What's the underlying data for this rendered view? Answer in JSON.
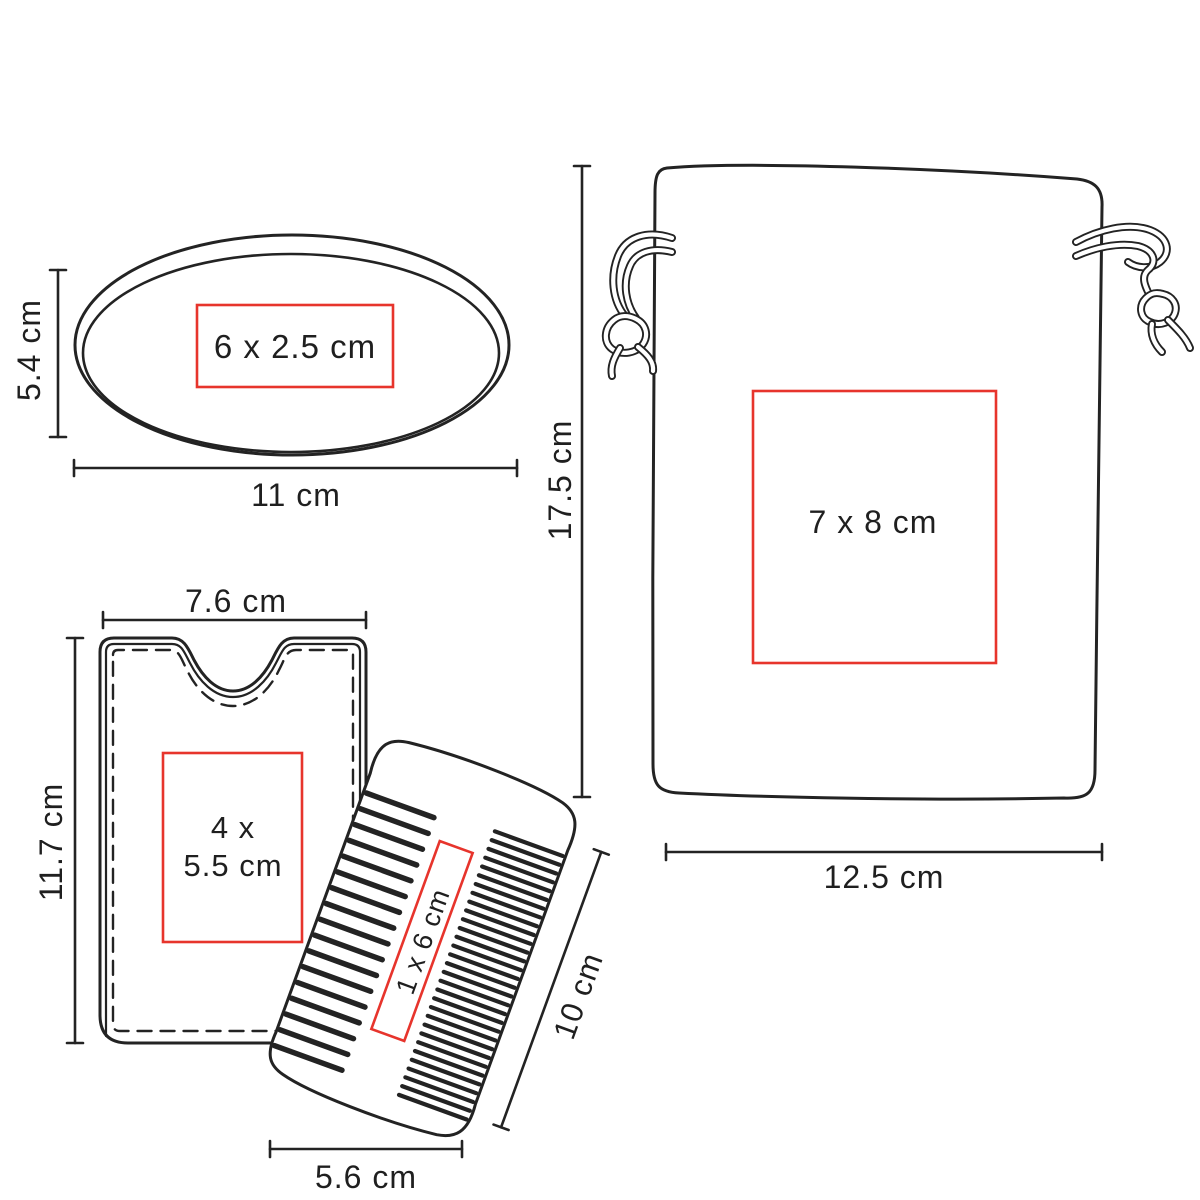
{
  "colors": {
    "background": "#ffffff",
    "line": "#232323",
    "accent": "#e7342c",
    "text": "#1f1f1f"
  },
  "mirror": {
    "print_area": "6 x 2.5 cm",
    "height": "5.4 cm",
    "width": "11 cm"
  },
  "pouch": {
    "print_area": "7 x 8 cm",
    "height": "17.5 cm",
    "width": "12.5 cm"
  },
  "sleeve": {
    "print_area_line1": "4 x",
    "print_area_line2": "5.5 cm",
    "width": "7.6 cm",
    "height": "11.7 cm"
  },
  "comb": {
    "print_area": "1 x 6 cm",
    "length": "10 cm",
    "width": "5.6 cm"
  }
}
